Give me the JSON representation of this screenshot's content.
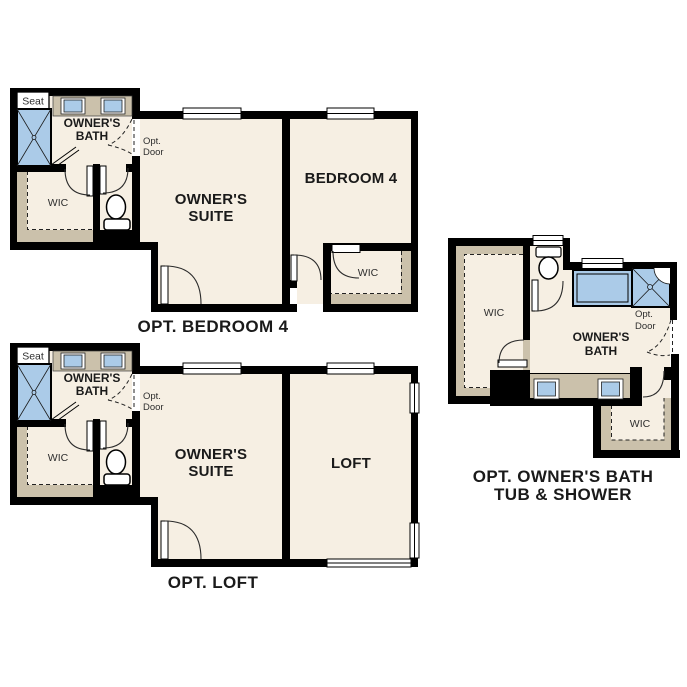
{
  "page": {
    "background": "#ffffff"
  },
  "colors": {
    "wall": "#000000",
    "floor": "#f6efe3",
    "cabinet_tan": "#cbc1ab",
    "fixture_blue": "#abcbe8",
    "label_text": "#1a1a1a"
  },
  "plans": [
    {
      "id": "opt-bedroom-4",
      "caption": "OPT. BEDROOM 4",
      "labels": {
        "seat": "Seat",
        "owners_bath": [
          "OWNER'S",
          "BATH"
        ],
        "opt_door": [
          "Opt.",
          "Door"
        ],
        "wic": "WIC",
        "owners_suite": [
          "OWNER'S",
          "SUITE"
        ],
        "bedroom": "BEDROOM 4",
        "bedroom_wic": "WIC"
      }
    },
    {
      "id": "opt-loft",
      "caption": "OPT. LOFT",
      "labels": {
        "seat": "Seat",
        "owners_bath": [
          "OWNER'S",
          "BATH"
        ],
        "opt_door": [
          "Opt.",
          "Door"
        ],
        "wic": "WIC",
        "owners_suite": [
          "OWNER'S",
          "SUITE"
        ],
        "loft": "LOFT"
      }
    },
    {
      "id": "opt-owners-bath-tub-shower",
      "caption": [
        "OPT. OWNER'S BATH",
        "TUB & SHOWER"
      ],
      "labels": {
        "wic": "WIC",
        "owners_bath": [
          "OWNER'S",
          "BATH"
        ],
        "opt_door": [
          "Opt.",
          "Door"
        ],
        "wic_2": "WIC"
      }
    }
  ]
}
